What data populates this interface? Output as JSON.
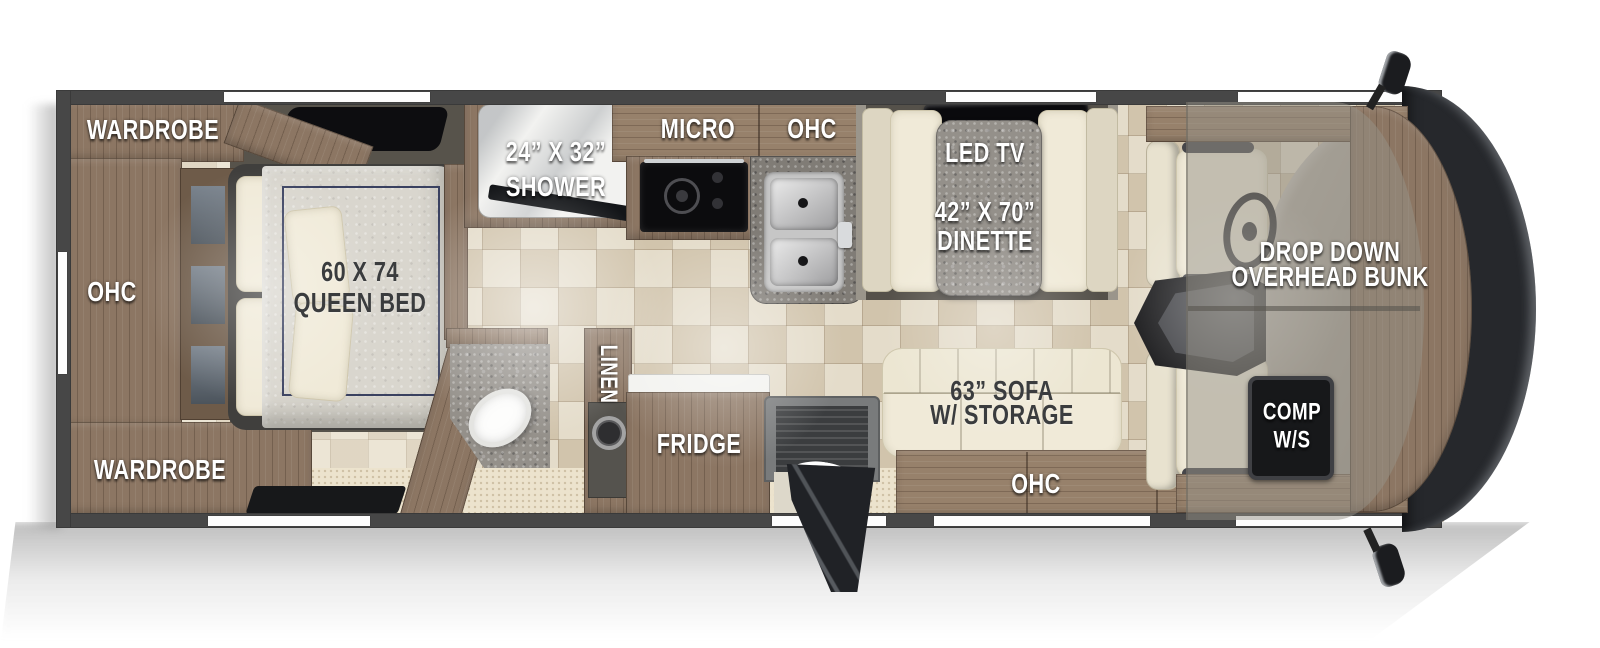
{
  "diagram_type": "rv-motorhome-floorplan-top-view",
  "labels": {
    "bedroom": {
      "wardrobe_top": "WARDROBE",
      "ohc_rear": "OHC",
      "wardrobe_bottom": "WARDROBE",
      "bed_dim": "60 X 74",
      "bed_name": "QUEEN BED"
    },
    "bathroom": {
      "shower_dim": "24” X 32”",
      "shower_name": "SHOWER",
      "linen": "LINEN"
    },
    "kitchen": {
      "micro": "MICRO",
      "ohc": "OHC",
      "fridge": "FRIDGE"
    },
    "living": {
      "led_tv": "LED TV",
      "dinette_dim": "42” X 70”",
      "dinette_name": "DINETTE",
      "sofa_dim": "63” SOFA",
      "sofa_storage": "W/ STORAGE",
      "ohc": "OHC"
    },
    "cab": {
      "bunk_line1": "DROP DOWN",
      "bunk_line2": "OVERHEAD BUNK",
      "comp_line1": "COMP",
      "comp_line2": "W/S"
    }
  },
  "colors": {
    "wall": "#474747",
    "window": "#ffffff",
    "cabinet_wood": "#8c7663",
    "counter_granite": "#94908a",
    "floor_tile": "#ddd2bb",
    "carpet": "#ece3cd",
    "upholstery_cream": "#f0ead8",
    "mattress": "#d9d6ce",
    "mattress_trim": "#3a4160",
    "slide_floor": "#57534b",
    "appliance_black": "#101012",
    "front_cap": "#26282c",
    "dashboard": "#a9a39a",
    "label_white": "#ffffff",
    "label_dark": "#3a3c3e"
  }
}
